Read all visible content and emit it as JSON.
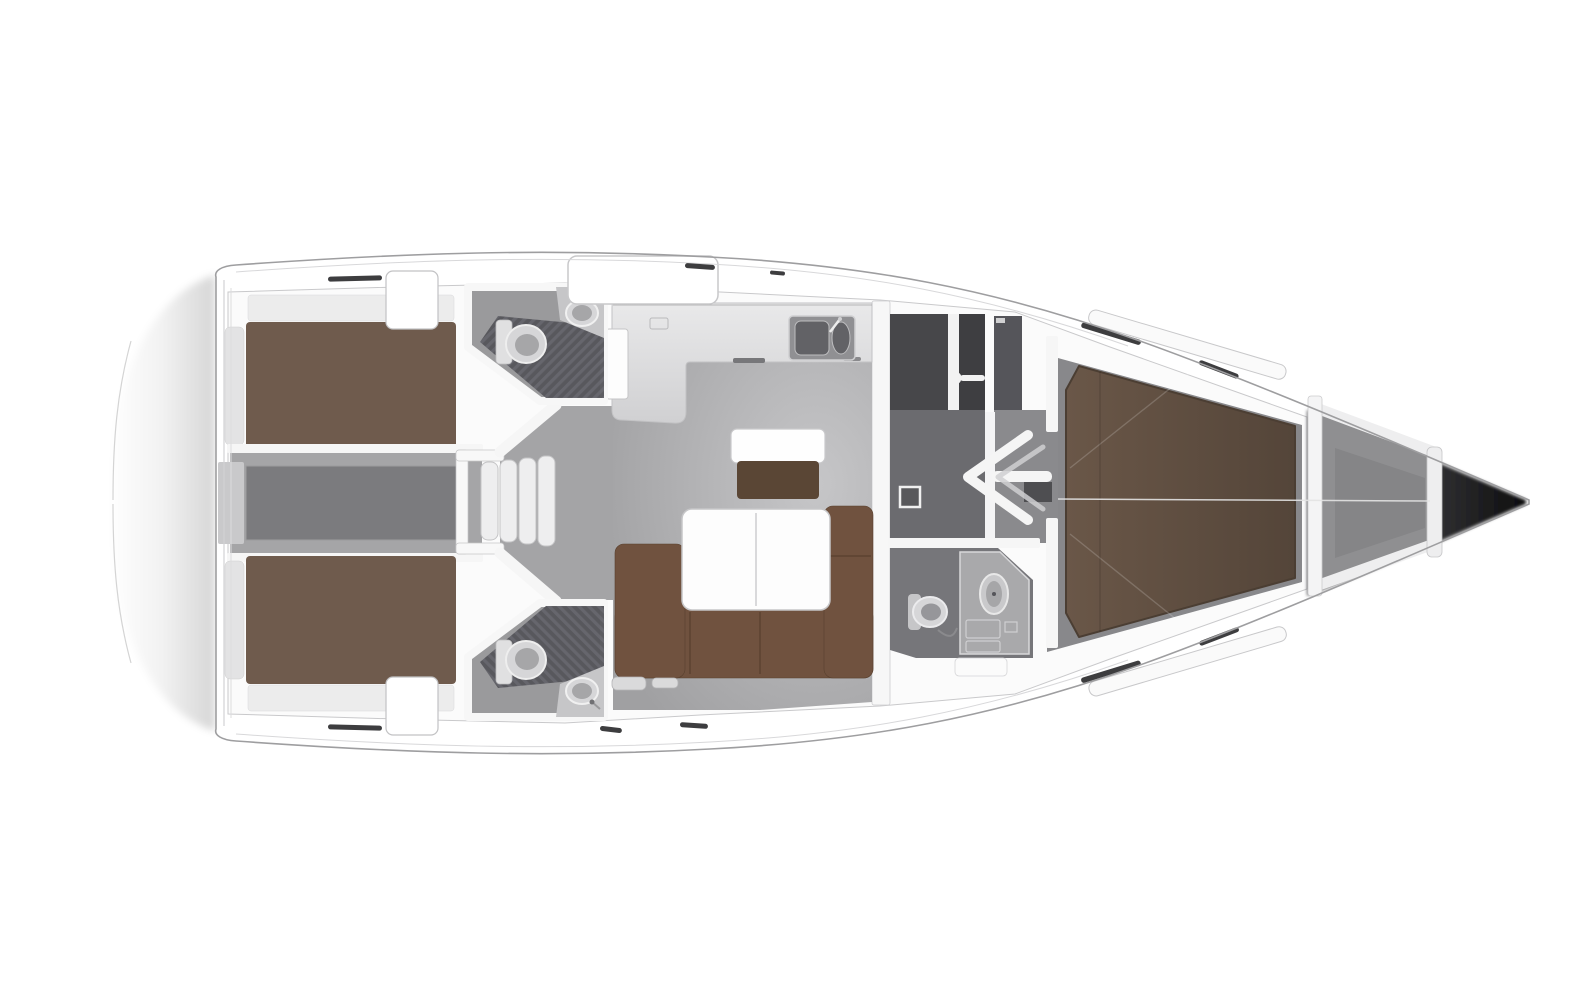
{
  "diagram": {
    "type": "floor-plan",
    "subject": "sailing-yacht-interior-top-view",
    "orientation": {
      "bow": "right",
      "stern": "left"
    },
    "regions": [
      {
        "id": "aft-cabin-port",
        "label": "aft double cabin (port)"
      },
      {
        "id": "aft-cabin-starboard",
        "label": "aft double cabin (starboard)"
      },
      {
        "id": "engine-compartment",
        "label": "engine compartment"
      },
      {
        "id": "companionway-steps",
        "label": "companionway steps"
      },
      {
        "id": "head-aft-port",
        "label": "aft head with shower (port)"
      },
      {
        "id": "head-aft-starboard",
        "label": "aft head with shower (starboard)"
      },
      {
        "id": "galley",
        "label": "L-shaped galley with double sink"
      },
      {
        "id": "salon",
        "label": "salon with L-sofa and table"
      },
      {
        "id": "navigation-area",
        "label": "navigation / chart area"
      },
      {
        "id": "passageway",
        "label": "passageway with open door"
      },
      {
        "id": "head-forward",
        "label": "forward head"
      },
      {
        "id": "forward-cabin",
        "label": "forward V-berth cabin"
      },
      {
        "id": "anchor-locker",
        "label": "anchor locker / bow"
      }
    ],
    "fixtures": [
      "double-berth-port",
      "double-berth-starboard",
      "v-berth",
      "l-sofa",
      "saloon-table",
      "side-table",
      "galley-double-sink",
      "toilet-x3",
      "washbasin-x3",
      "shower-grate-x2",
      "steps-x4",
      "open-door-chevron",
      "instrument-pointer"
    ]
  },
  "palette": {
    "page_bg": "#ffffff",
    "hull_stroke": "#9e9ea0",
    "deck_hairline": "#d8d8da",
    "slab": "#fbfbfb",
    "wall": "#f6f6f6",
    "wall_line": "#c9c9cb",
    "salon_floor": "#a0a0a2",
    "salon_floor_light": "#c6c6c8",
    "passage_floor": "#a4a4a6",
    "corridor_dark": "#6b6b6f",
    "corridor_light": "#8a8a8d",
    "engine_outer": "#a5a5a7",
    "engine_inner": "#7b7b7e",
    "engine_step": "#c9c9cb",
    "counter": "#d3d3d5",
    "sink_unit": "#909093",
    "basin": "#626266",
    "grate_a": "#55555a",
    "grate_b": "#63636a",
    "head_floor": "#9a9a9c",
    "head_floor_fwd": "#76767a",
    "vanity": "#a9a9ab",
    "fixture": "#d6d6d8",
    "fixture_inner": "#a6a6a8",
    "tank": "#e0e0e1",
    "bed": "#6f5b4d",
    "pillow": "#e3e3e4",
    "shelf_band": "#ececec",
    "sofa": "#70523f",
    "table": "#fdfdfd",
    "table_line": "#d9d9db",
    "side_table": "#5a4635",
    "chart1": "#47474a",
    "chart2": "#3e3e41",
    "chart3": "#55555a",
    "notch": "#4e4e51",
    "locker_floor": "#8f8f91",
    "locker_inner": "#828285",
    "fwd_floor": "#88888b",
    "tick": "#3d3d3f"
  }
}
